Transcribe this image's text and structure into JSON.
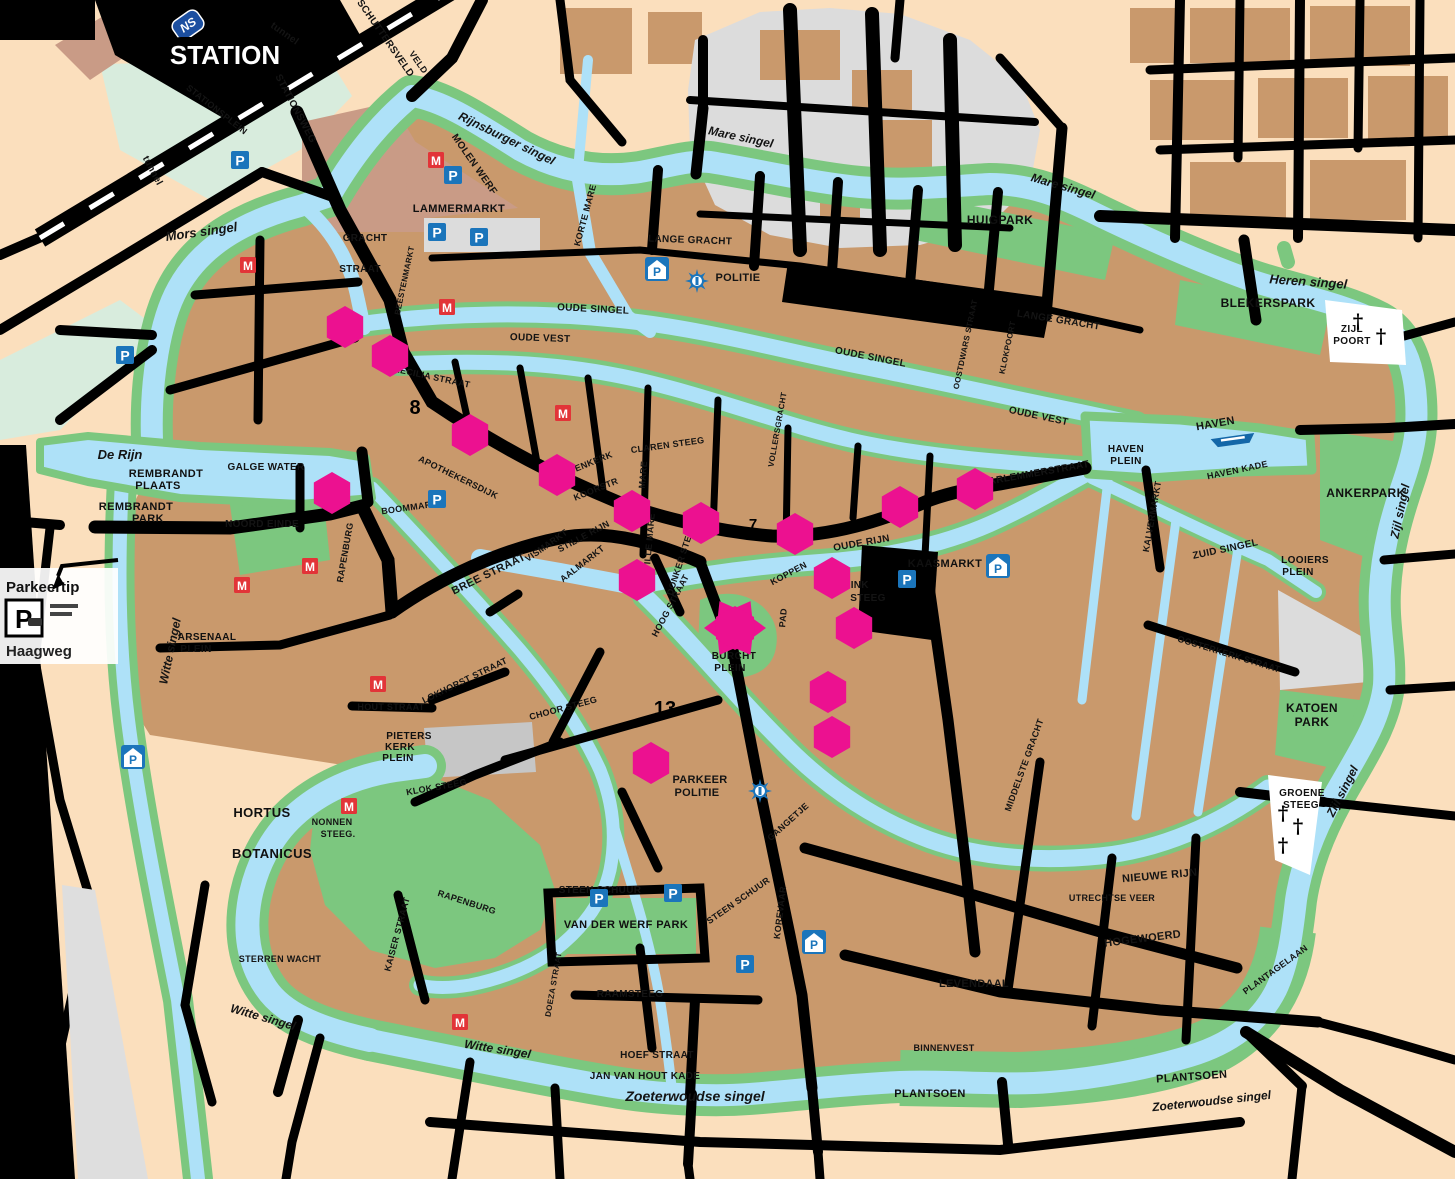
{
  "map": {
    "city": "Leiden city centre tourist map",
    "colors": {
      "background": "#FBDFBD",
      "block_brown": "#C9996C",
      "block_rose": "#C99B86",
      "water": "#AEE1F8",
      "park_green": "#7CC77F",
      "mint": "#D8ECDD",
      "road_black": "#000000",
      "gray_zone": "#DCDCDC",
      "marker_pink": "#EC1190",
      "icon_blue": "#1B75BB",
      "icon_red": "#E23438",
      "ns_blue": "#1C4FA0"
    },
    "station": {
      "pill": "STATION",
      "ns": "NS"
    },
    "parkeertip": {
      "title": "Parkeertip",
      "p": "P",
      "road": "Haagweg"
    },
    "labels": [
      {
        "t": "Mors singel",
        "x": 202,
        "y": 236,
        "s": 13,
        "r": -8,
        "k": "w"
      },
      {
        "t": "Rijnsburger  singel",
        "x": 505,
        "y": 142,
        "s": 12,
        "r": 26,
        "k": "w"
      },
      {
        "t": "Mare singel",
        "x": 740,
        "y": 141,
        "s": 12,
        "r": 12,
        "k": "w"
      },
      {
        "t": "Mare  singel",
        "x": 1062,
        "y": 190,
        "s": 12,
        "r": 16,
        "k": "w"
      },
      {
        "t": "Heren  singel",
        "x": 1308,
        "y": 286,
        "s": 13,
        "r": 4,
        "k": "w"
      },
      {
        "t": "Zijl singel",
        "x": 1404,
        "y": 512,
        "s": 12,
        "r": -78,
        "k": "w"
      },
      {
        "t": "Zijl  singel",
        "x": 1346,
        "y": 793,
        "s": 12,
        "r": -63,
        "k": "w"
      },
      {
        "t": "Zoeterwoudse singel",
        "x": 695,
        "y": 1101,
        "s": 14,
        "r": 0,
        "k": "w"
      },
      {
        "t": "Zoeterwoudse    singel",
        "x": 1212,
        "y": 1105,
        "s": 12,
        "r": -6,
        "k": "w"
      },
      {
        "t": "Witte singel",
        "x": 174,
        "y": 652,
        "s": 12,
        "r": -78,
        "k": "w"
      },
      {
        "t": "Witte  singel",
        "x": 262,
        "y": 1021,
        "s": 12,
        "r": 16,
        "k": "w"
      },
      {
        "t": "Witte singel",
        "x": 497,
        "y": 1053,
        "s": 12,
        "r": 9,
        "k": "w"
      },
      {
        "t": "De Rijn",
        "x": 120,
        "y": 459,
        "s": 13,
        "r": 0,
        "k": "w"
      },
      {
        "t": "HUIGPARK",
        "x": 1000,
        "y": 224,
        "s": 12,
        "r": 0,
        "k": "a"
      },
      {
        "t": "BLEKERSPARK",
        "x": 1268,
        "y": 307,
        "s": 12,
        "r": 0,
        "k": "a"
      },
      {
        "t": "ANKERPARK",
        "x": 1366,
        "y": 497,
        "s": 12,
        "r": 0,
        "k": "a"
      },
      {
        "t": "KATOEN",
        "x": 1312,
        "y": 712,
        "s": 12,
        "r": 0,
        "k": "a"
      },
      {
        "t": "PARK",
        "x": 1312,
        "y": 726,
        "s": 12,
        "r": 0,
        "k": "a"
      },
      {
        "t": "PLANTSOEN",
        "x": 930,
        "y": 1097,
        "s": 11,
        "r": 0,
        "k": "a"
      },
      {
        "t": "PLANTSOEN",
        "x": 1192,
        "y": 1080,
        "s": 11,
        "r": -4,
        "k": "a"
      },
      {
        "t": "HORTUS",
        "x": 262,
        "y": 817,
        "s": 13,
        "r": 0,
        "k": "a"
      },
      {
        "t": "BOTANICUS",
        "x": 272,
        "y": 858,
        "s": 13,
        "r": 0,
        "k": "a"
      },
      {
        "t": "REMBRANDT",
        "x": 166,
        "y": 477,
        "s": 11,
        "r": 0,
        "k": "a"
      },
      {
        "t": "PLAATS",
        "x": 158,
        "y": 489,
        "s": 11,
        "r": 0,
        "k": "a"
      },
      {
        "t": "REMBRANDT",
        "x": 136,
        "y": 510,
        "s": 11,
        "r": 0,
        "k": "a"
      },
      {
        "t": "PARK",
        "x": 148,
        "y": 522,
        "s": 11,
        "r": 0,
        "k": "a"
      },
      {
        "t": "VAN DER WERF PARK",
        "x": 626,
        "y": 928,
        "s": 11,
        "r": 0,
        "k": "a"
      },
      {
        "t": "ZIJL",
        "x": 1352,
        "y": 332,
        "s": 10,
        "r": 0,
        "k": "a"
      },
      {
        "t": "POORT",
        "x": 1352,
        "y": 344,
        "s": 10,
        "r": 0,
        "k": "a"
      },
      {
        "t": "GROENE",
        "x": 1302,
        "y": 796,
        "s": 10,
        "r": 0,
        "k": "a"
      },
      {
        "t": "STEEG",
        "x": 1301,
        "y": 808,
        "s": 10,
        "r": 0,
        "k": "a"
      },
      {
        "t": "LOOIERS",
        "x": 1305,
        "y": 563,
        "s": 10,
        "r": 0,
        "k": "a"
      },
      {
        "t": "PLEIN",
        "x": 1298,
        "y": 575,
        "s": 10,
        "r": 0,
        "k": "a"
      },
      {
        "t": "BURCHT",
        "x": 734,
        "y": 659,
        "s": 10,
        "r": 0,
        "k": "a"
      },
      {
        "t": "PLEIN",
        "x": 730,
        "y": 671,
        "s": 10,
        "r": 0,
        "k": "a"
      },
      {
        "t": "PIETERS",
        "x": 409,
        "y": 739,
        "s": 10,
        "r": 0,
        "k": "a"
      },
      {
        "t": "KERK",
        "x": 400,
        "y": 750,
        "s": 10,
        "r": 0,
        "k": "a"
      },
      {
        "t": "PLEIN",
        "x": 398,
        "y": 761,
        "s": 10,
        "r": 0,
        "k": "a"
      },
      {
        "t": "LAMMERMARKT",
        "x": 459,
        "y": 212,
        "s": 11,
        "r": 0,
        "k": "a"
      },
      {
        "t": "KAASMARKT",
        "x": 945,
        "y": 567,
        "s": 11,
        "r": 0,
        "k": "a"
      },
      {
        "t": "ARSENAAL",
        "x": 207,
        "y": 640,
        "s": 10,
        "r": 0,
        "k": "a"
      },
      {
        "t": "PLEIN",
        "x": 196,
        "y": 652,
        "s": 10,
        "r": 0,
        "k": "a"
      },
      {
        "t": "HAVEN",
        "x": 1126,
        "y": 452,
        "s": 10,
        "r": 0,
        "k": "a"
      },
      {
        "t": "PLEIN",
        "x": 1126,
        "y": 464,
        "s": 10,
        "r": 0,
        "k": "a"
      },
      {
        "t": "STATIONSWEG",
        "x": 293,
        "y": 110,
        "s": 10,
        "r": 62,
        "k": "s"
      },
      {
        "t": "STATIONSPLEIN",
        "x": 215,
        "y": 112,
        "s": 9,
        "r": 38,
        "k": "s"
      },
      {
        "t": "MOLEN WERF",
        "x": 472,
        "y": 166,
        "s": 10,
        "r": 55,
        "k": "s"
      },
      {
        "t": "SCHUTTERSVELD",
        "x": 383,
        "y": 40,
        "s": 10,
        "r": 55,
        "k": "s"
      },
      {
        "t": "tunnel",
        "x": 150,
        "y": 172,
        "s": 10,
        "r": 62,
        "k": "s"
      },
      {
        "t": "tunnel",
        "x": 283,
        "y": 36,
        "s": 10,
        "r": 35,
        "k": "s"
      },
      {
        "t": "GRACHT",
        "x": 365,
        "y": 241,
        "s": 10,
        "r": 0,
        "k": "s"
      },
      {
        "t": "STRAAT",
        "x": 360,
        "y": 272,
        "s": 10,
        "r": 0,
        "k": "s"
      },
      {
        "t": "BEESTENMARKT",
        "x": 407,
        "y": 281,
        "s": 8,
        "r": -78,
        "k": "s"
      },
      {
        "t": "OUDE SINGEL",
        "x": 593,
        "y": 312,
        "s": 10,
        "r": 3,
        "k": "s"
      },
      {
        "t": "OUDE  SINGEL",
        "x": 870,
        "y": 360,
        "s": 10,
        "r": 11,
        "k": "s"
      },
      {
        "t": "OUDE VEST",
        "x": 540,
        "y": 341,
        "s": 10,
        "r": 2,
        "k": "s"
      },
      {
        "t": "OUDE VEST",
        "x": 1038,
        "y": 419,
        "s": 10,
        "r": 12,
        "k": "s"
      },
      {
        "t": "LANGE GRACHT",
        "x": 690,
        "y": 243,
        "s": 10,
        "r": 2,
        "k": "s"
      },
      {
        "t": "LANGE GRACHT",
        "x": 1058,
        "y": 323,
        "s": 10,
        "r": 9,
        "k": "s"
      },
      {
        "t": "HAARLEMMERSTRAAT",
        "x": 1032,
        "y": 477,
        "s": 10,
        "r": -10,
        "k": "s"
      },
      {
        "t": "CAECILIA STRAAT",
        "x": 428,
        "y": 379,
        "s": 9,
        "r": 12,
        "k": "s"
      },
      {
        "t": "VROUWENKERK",
        "x": 578,
        "y": 471,
        "s": 9,
        "r": -22,
        "k": "s"
      },
      {
        "t": "KOORSTR",
        "x": 597,
        "y": 492,
        "s": 9,
        "r": -22,
        "k": "s"
      },
      {
        "t": "CLAREN STEEG",
        "x": 668,
        "y": 448,
        "s": 9,
        "r": -8,
        "k": "s"
      },
      {
        "t": "STILLE RIJN",
        "x": 585,
        "y": 539,
        "s": 9,
        "r": -28,
        "k": "s"
      },
      {
        "t": "VISMARKT",
        "x": 548,
        "y": 548,
        "s": 9,
        "r": -35,
        "k": "s"
      },
      {
        "t": "AALMARKT",
        "x": 584,
        "y": 566,
        "s": 9,
        "r": -38,
        "k": "s"
      },
      {
        "t": "DONKER STEEG",
        "x": 684,
        "y": 560,
        "s": 9,
        "r": -72,
        "k": "s"
      },
      {
        "t": "STILLE MARE",
        "x": 652,
        "y": 545,
        "s": 9,
        "r": -85,
        "k": "s"
      },
      {
        "t": "HOOG STRAAT",
        "x": 673,
        "y": 607,
        "s": 9,
        "r": -62,
        "k": "s"
      },
      {
        "t": "BREE STRAAT",
        "x": 490,
        "y": 577,
        "s": 11,
        "r": -26,
        "k": "s"
      },
      {
        "t": "BOOMMARKT",
        "x": 413,
        "y": 510,
        "s": 9,
        "r": -8,
        "k": "s"
      },
      {
        "t": "APOTHEKERSDIJK",
        "x": 457,
        "y": 480,
        "s": 9,
        "r": 26,
        "k": "s"
      },
      {
        "t": "OUDE RIJN",
        "x": 862,
        "y": 546,
        "s": 10,
        "r": -10,
        "k": "s"
      },
      {
        "t": "KOPPEN",
        "x": 790,
        "y": 576,
        "s": 9,
        "r": -28,
        "k": "s"
      },
      {
        "t": "HINK",
        "x": 856,
        "y": 588,
        "s": 10,
        "r": 0,
        "k": "s"
      },
      {
        "t": "STEEG",
        "x": 868,
        "y": 601,
        "s": 10,
        "r": 0,
        "k": "s"
      },
      {
        "t": "PAD",
        "x": 786,
        "y": 618,
        "s": 9,
        "r": -85,
        "k": "s"
      },
      {
        "t": "HAVEN",
        "x": 1216,
        "y": 427,
        "s": 11,
        "r": -10,
        "k": "s"
      },
      {
        "t": "HAVEN KADE",
        "x": 1238,
        "y": 473,
        "s": 9,
        "r": -12,
        "k": "s"
      },
      {
        "t": "ZUID SINGEL",
        "x": 1226,
        "y": 552,
        "s": 10,
        "r": -12,
        "k": "s"
      },
      {
        "t": "KALVERMARKT",
        "x": 1155,
        "y": 517,
        "s": 9,
        "r": -80,
        "k": "s"
      },
      {
        "t": "OOSTERKERK STRAAT",
        "x": 1228,
        "y": 657,
        "s": 9,
        "r": 17,
        "k": "s"
      },
      {
        "t": "NIEUWE RIJN",
        "x": 1160,
        "y": 879,
        "s": 11,
        "r": -5,
        "k": "s"
      },
      {
        "t": "UTRECHTSE VEER",
        "x": 1112,
        "y": 901,
        "s": 9,
        "r": 0,
        "k": "s"
      },
      {
        "t": "HOGEWOERD",
        "x": 1143,
        "y": 942,
        "s": 11,
        "r": -7,
        "k": "s"
      },
      {
        "t": "LEVENDAAL",
        "x": 974,
        "y": 987,
        "s": 11,
        "r": 0,
        "k": "s"
      },
      {
        "t": "GANGETJE",
        "x": 790,
        "y": 824,
        "s": 9,
        "r": -42,
        "k": "s"
      },
      {
        "t": "MIDDELSTE GRACHT",
        "x": 1027,
        "y": 766,
        "s": 9,
        "r": -70,
        "k": "s"
      },
      {
        "t": "KOREVAAR",
        "x": 783,
        "y": 913,
        "s": 9,
        "r": -83,
        "k": "s"
      },
      {
        "t": "STEEN SCHUUR",
        "x": 600,
        "y": 893,
        "s": 10,
        "r": 0,
        "k": "s"
      },
      {
        "t": "STEEN SCHUUR",
        "x": 740,
        "y": 903,
        "s": 9,
        "r": -35,
        "k": "s"
      },
      {
        "t": "RAAMSTEEG",
        "x": 630,
        "y": 997,
        "s": 10,
        "r": 0,
        "k": "s"
      },
      {
        "t": "HOEF STRAAT",
        "x": 657,
        "y": 1058,
        "s": 10,
        "r": 0,
        "k": "s"
      },
      {
        "t": "JAN VAN HOUT   KADE",
        "x": 645,
        "y": 1079,
        "s": 10,
        "r": 0,
        "k": "s"
      },
      {
        "t": "CHOOR STEEG",
        "x": 564,
        "y": 711,
        "s": 9,
        "r": -15,
        "k": "s"
      },
      {
        "t": "HOUT STRAAT",
        "x": 391,
        "y": 710,
        "s": 9,
        "r": 0,
        "k": "s"
      },
      {
        "t": "LOKHORST STRAAT",
        "x": 466,
        "y": 683,
        "s": 9,
        "r": -26,
        "k": "s"
      },
      {
        "t": "KLOK STEEG",
        "x": 437,
        "y": 790,
        "s": 9,
        "r": -10,
        "k": "s"
      },
      {
        "t": "PARKEER",
        "x": 700,
        "y": 783,
        "s": 11,
        "r": 0,
        "k": "s"
      },
      {
        "t": "POLITIE",
        "x": 697,
        "y": 796,
        "s": 11,
        "r": 0,
        "k": "s"
      },
      {
        "t": "POLITIE",
        "x": 738,
        "y": 281,
        "s": 11,
        "r": 0,
        "k": "s"
      },
      {
        "t": "NONNEN",
        "x": 332,
        "y": 825,
        "s": 9,
        "r": 0,
        "k": "s"
      },
      {
        "t": "STEEG.",
        "x": 338,
        "y": 837,
        "s": 9,
        "r": 0,
        "k": "s"
      },
      {
        "t": "RAPENBURG",
        "x": 348,
        "y": 553,
        "s": 9,
        "r": -80,
        "k": "s"
      },
      {
        "t": "RAPENBURG",
        "x": 466,
        "y": 905,
        "s": 9,
        "r": 18,
        "k": "s"
      },
      {
        "t": "KAISER STRAAT",
        "x": 400,
        "y": 935,
        "s": 9,
        "r": -75,
        "k": "s"
      },
      {
        "t": "STERREN WACHT",
        "x": 280,
        "y": 962,
        "s": 9,
        "r": 0,
        "k": "s"
      },
      {
        "t": "NOORD EINDE",
        "x": 262,
        "y": 527,
        "s": 10,
        "r": 0,
        "k": "s"
      },
      {
        "t": "GALGE WATER",
        "x": 266,
        "y": 470,
        "s": 10,
        "r": 0,
        "k": "s"
      },
      {
        "t": "VOLLERSGRACHT",
        "x": 780,
        "y": 430,
        "s": 8,
        "r": -80,
        "k": "s"
      },
      {
        "t": "OOSTDWARS STRAAT",
        "x": 968,
        "y": 345,
        "s": 8,
        "r": -78,
        "k": "s"
      },
      {
        "t": "KLOKPOORT",
        "x": 1010,
        "y": 348,
        "s": 8,
        "r": -78,
        "k": "s"
      },
      {
        "t": "BINNENVEST",
        "x": 944,
        "y": 1051,
        "s": 9,
        "r": 0,
        "k": "s"
      },
      {
        "t": "PLANTAGELAAN",
        "x": 1277,
        "y": 972,
        "s": 9,
        "r": -36,
        "k": "s"
      },
      {
        "t": "MARE",
        "x": 646,
        "y": 475,
        "s": 9,
        "r": -85,
        "k": "s"
      },
      {
        "t": "KORTE MARE",
        "x": 588,
        "y": 216,
        "s": 9,
        "r": -75,
        "k": "s"
      },
      {
        "t": "VELD",
        "x": 416,
        "y": 64,
        "s": 9,
        "r": 55,
        "k": "s"
      },
      {
        "t": "DOEZA STRAAT",
        "x": 556,
        "y": 985,
        "s": 8,
        "r": -80,
        "k": "s"
      },
      {
        "t": "8",
        "x": 415,
        "y": 414,
        "s": 20,
        "r": 0,
        "k": "n"
      },
      {
        "t": "7",
        "x": 753,
        "y": 529,
        "s": 15,
        "r": 0,
        "k": "n"
      },
      {
        "t": "13",
        "x": 665,
        "y": 715,
        "s": 20,
        "r": 0,
        "k": "n"
      }
    ],
    "markers": [
      [
        345,
        327
      ],
      [
        390,
        356
      ],
      [
        470,
        435
      ],
      [
        557,
        475
      ],
      [
        632,
        511
      ],
      [
        332,
        493
      ],
      [
        701,
        523
      ],
      [
        795,
        534
      ],
      [
        900,
        507
      ],
      [
        975,
        489
      ],
      [
        637,
        580
      ],
      [
        832,
        578
      ],
      [
        854,
        628
      ],
      [
        828,
        692
      ],
      [
        832,
        737
      ],
      [
        651,
        763
      ]
    ],
    "burcht_marker": [
      735,
      628
    ],
    "icons": {
      "parking": [
        [
          240,
          160
        ],
        [
          125,
          355
        ],
        [
          453,
          175
        ],
        [
          437,
          232
        ],
        [
          479,
          237
        ],
        [
          437,
          499
        ],
        [
          907,
          579
        ],
        [
          599,
          898
        ],
        [
          673,
          893
        ],
        [
          745,
          964
        ]
      ],
      "parking_garage": [
        [
          657,
          269
        ],
        [
          998,
          566
        ],
        [
          814,
          942
        ],
        [
          133,
          757
        ]
      ],
      "museum": [
        [
          436,
          160
        ],
        [
          248,
          265
        ],
        [
          447,
          307
        ],
        [
          563,
          413
        ],
        [
          310,
          566
        ],
        [
          242,
          585
        ],
        [
          378,
          684
        ],
        [
          349,
          806
        ],
        [
          460,
          1022
        ]
      ],
      "police": [
        [
          697,
          281
        ],
        [
          760,
          791
        ]
      ],
      "crosses": [
        [
          1358,
          321
        ],
        [
          1381,
          336
        ],
        [
          1283,
          813
        ],
        [
          1298,
          826
        ],
        [
          1283,
          845
        ]
      ]
    },
    "boat": [
      1233,
      440
    ]
  }
}
